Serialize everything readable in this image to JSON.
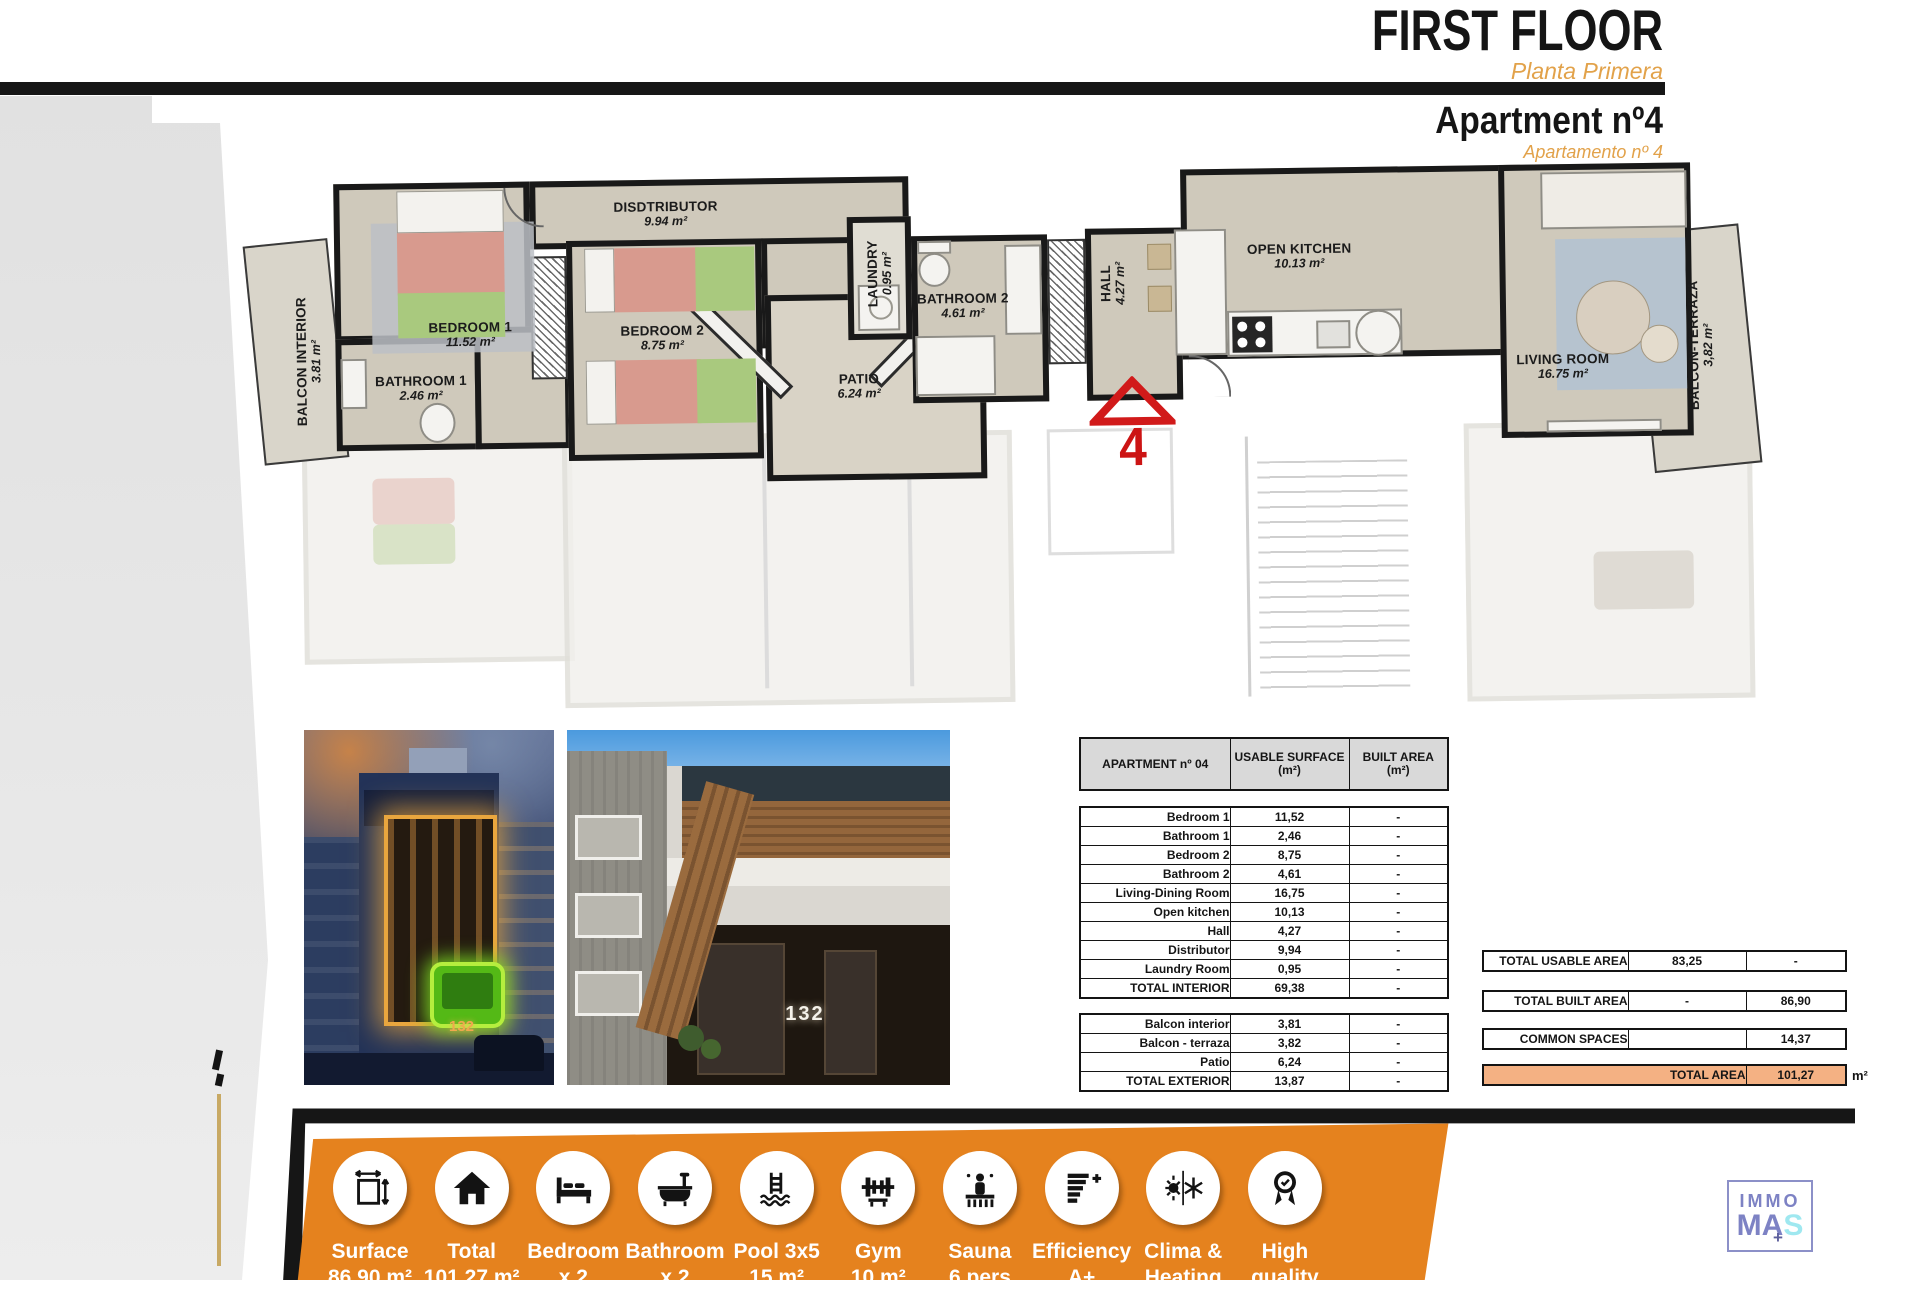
{
  "header": {
    "title": "FIRST FLOOR",
    "subtitle": "Planta Primera",
    "apartment_title": "Apartment nº4",
    "apartment_subtitle": "Apartamento nº 4"
  },
  "floor_plan": {
    "marker": "4",
    "rooms": [
      {
        "name": "BALCON INTERIOR",
        "area": "3.81 m²"
      },
      {
        "name": "BEDROOM 1",
        "area": "11.52 m²"
      },
      {
        "name": "BATHROOM 1",
        "area": "2.46 m²"
      },
      {
        "name": "BEDROOM 2",
        "area": "8.75 m²"
      },
      {
        "name": "DISDTRIBUTOR",
        "area": "9.94 m²"
      },
      {
        "name": "PATIO",
        "area": "6.24 m²"
      },
      {
        "name": "LAUNDRY",
        "area": "0.95 m²"
      },
      {
        "name": "BATHROOM 2",
        "area": "4.61 m²"
      },
      {
        "name": "HALL",
        "area": "4.27 m²"
      },
      {
        "name": "OPEN KITCHEN",
        "area": "10.13 m²"
      },
      {
        "name": "LIVING ROOM",
        "area": "16.75 m²"
      },
      {
        "name": "BALCON-TERRAZA",
        "area": "3,82 m²"
      }
    ]
  },
  "photos": {
    "night_number": "132",
    "day_number": "132"
  },
  "area_table": {
    "header": {
      "col1": "APARTMENT nº 04",
      "col2_line1": "USABLE SURFACE",
      "col2_line2": "(m²)",
      "col3_line1": "BUILT AREA",
      "col3_line2": "(m²)"
    },
    "interior_rows": [
      [
        "Bedroom 1",
        "11,52",
        "-"
      ],
      [
        "Bathroom 1",
        "2,46",
        "-"
      ],
      [
        "Bedroom 2",
        "8,75",
        "-"
      ],
      [
        "Bathroom 2",
        "4,61",
        "-"
      ],
      [
        "Living-Dining Room",
        "16,75",
        "-"
      ],
      [
        "Open kitchen",
        "10,13",
        "-"
      ],
      [
        "Hall",
        "4,27",
        "-"
      ],
      [
        "Distributor",
        "9,94",
        "-"
      ],
      [
        "Laundry Room",
        "0,95",
        "-"
      ],
      [
        "TOTAL INTERIOR",
        "69,38",
        "-"
      ]
    ],
    "exterior_rows": [
      [
        "Balcon interior",
        "3,81",
        "-"
      ],
      [
        "Balcon - terraza",
        "3,82",
        "-"
      ],
      [
        "Patio",
        "6,24",
        "-"
      ],
      [
        "TOTAL EXTERIOR",
        "13,87",
        "-"
      ]
    ]
  },
  "area_summary": {
    "rows": [
      {
        "label": "TOTAL USABLE AREA",
        "usable": "83,25",
        "built": "-"
      },
      {
        "label": "TOTAL BUILT AREA",
        "usable": "-",
        "built": "86,90"
      },
      {
        "label": "COMMON SPACES",
        "usable": "",
        "built": "14,37"
      },
      {
        "label": "TOTAL AREA",
        "usable": "",
        "built": "101,27"
      }
    ],
    "unit": "m²"
  },
  "amenities": [
    {
      "label": "Surface",
      "value": "86.90 m²"
    },
    {
      "label": "Total",
      "value": "101.27 m²"
    },
    {
      "label": "Bedroom",
      "value": "x 2"
    },
    {
      "label": "Bathroom",
      "value": "x 2"
    },
    {
      "label": "Pool 3x5",
      "value": "15 m²"
    },
    {
      "label": "Gym",
      "value": "10 m²"
    },
    {
      "label": "Sauna",
      "value": "6 pers"
    },
    {
      "label": "Efficiency",
      "value": "A+"
    },
    {
      "label": "Clima &",
      "value": "Heating"
    },
    {
      "label": "High",
      "value": "quality"
    }
  ],
  "logo": {
    "word1": "IMMO",
    "word2a": "MA",
    "word2b": "S",
    "plus": "+"
  },
  "colors": {
    "accent_orange": "#E5821E",
    "subtitle_orange": "#E2A24A",
    "total_row_orange": "#F4B183",
    "marker_red": "#D11A1A",
    "highlight_green": "#54B916",
    "logo_purple": "#7D82C4",
    "logo_cyan": "#9FE8F0"
  }
}
